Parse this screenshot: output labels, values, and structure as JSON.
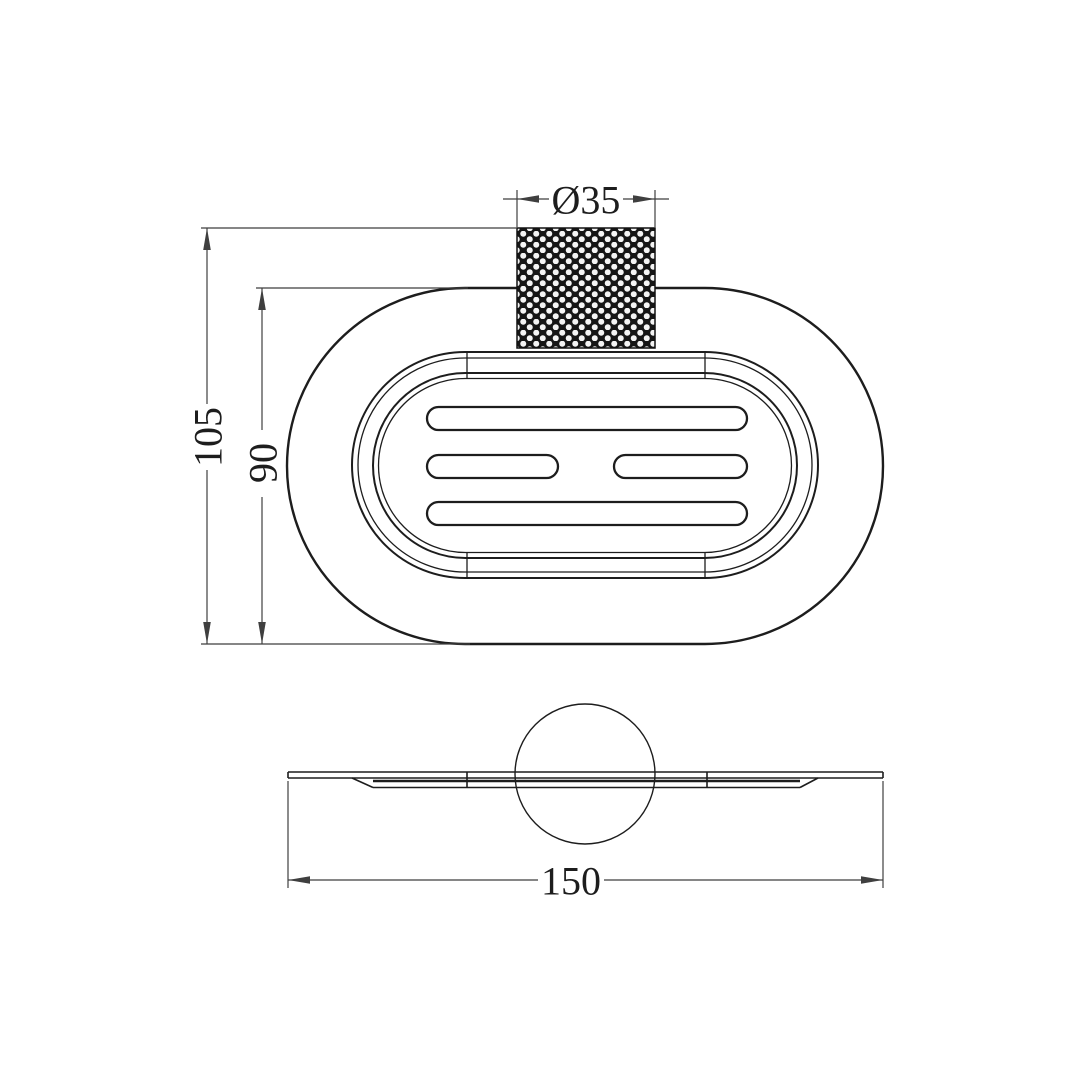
{
  "drawing": {
    "background": "#ffffff",
    "object_line_color": "#1d1d1d",
    "dimension_line_color": "#3f3f3f",
    "dimensions": {
      "knob_diameter": {
        "label": "Ø35"
      },
      "overall_height": {
        "label": "105"
      },
      "dish_height": {
        "label": "90"
      },
      "overall_width": {
        "label": "150"
      }
    }
  }
}
